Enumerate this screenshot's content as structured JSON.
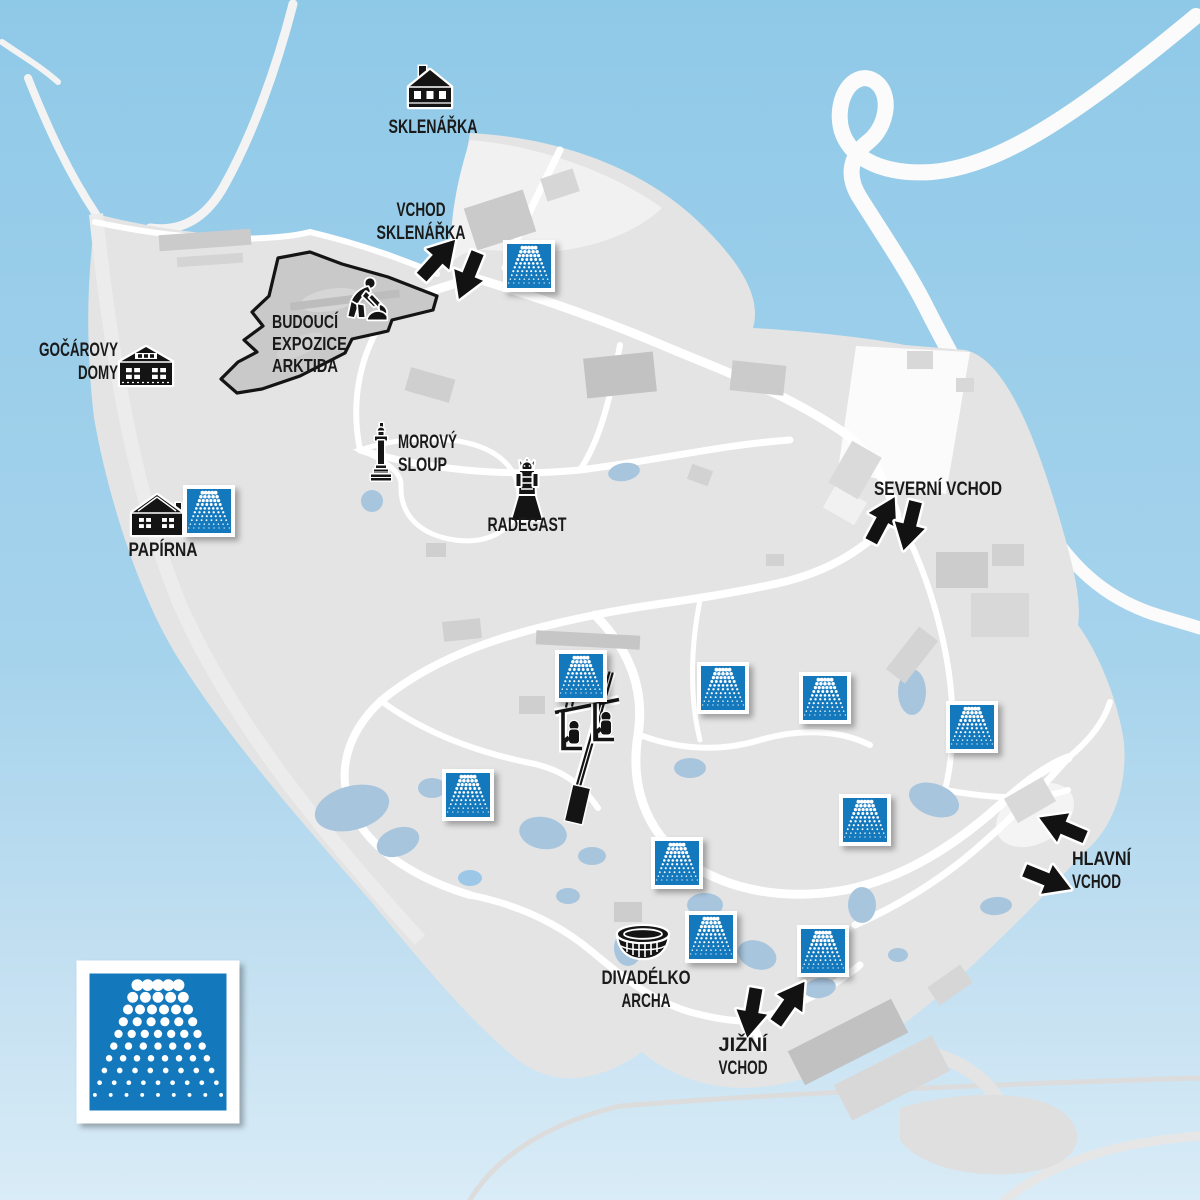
{
  "map_type": "zoo-area-map",
  "colors": {
    "station_blue": "#1478BD",
    "water_top": "#8FC9E8",
    "water_mid": "#A6D3EC",
    "water_bottom": "#D9ECF7",
    "land_grey": "#E4E4E4",
    "label_color": "#1A1A1A",
    "construction_outline": "#141414"
  },
  "labels": [
    {
      "id": "sklenarka",
      "lines": [
        "SKLENÁŘKA"
      ],
      "x": 433,
      "y": 133,
      "anchor": "middle",
      "size": 19
    },
    {
      "id": "vchod-sklenarka",
      "lines": [
        "VCHOD",
        "SKLENÁŘKA"
      ],
      "x": 421,
      "y": 216,
      "anchor": "middle",
      "size": 19
    },
    {
      "id": "budouci-expozice-arktida",
      "lines": [
        "BUDOUCÍ",
        "EXPOZICE",
        "ARKTIDA"
      ],
      "x": 272,
      "y": 328,
      "anchor": "start",
      "size": 18
    },
    {
      "id": "gocarovy-domy",
      "lines": [
        "GOČÁROVY",
        "DOMY"
      ],
      "x": 118,
      "y": 356,
      "anchor": "end",
      "size": 19
    },
    {
      "id": "papirna",
      "lines": [
        "PAPÍRNA"
      ],
      "x": 163,
      "y": 556,
      "anchor": "middle",
      "size": 19
    },
    {
      "id": "morovy-sloup",
      "lines": [
        "MOROVÝ",
        "SLOUP"
      ],
      "x": 398,
      "y": 448,
      "anchor": "start",
      "size": 19
    },
    {
      "id": "radegast",
      "lines": [
        "RADEGAST"
      ],
      "x": 527,
      "y": 531,
      "anchor": "middle",
      "size": 19
    },
    {
      "id": "severni-vchod",
      "lines": [
        "SEVERNÍ VCHOD"
      ],
      "x": 938,
      "y": 495,
      "anchor": "middle",
      "size": 19
    },
    {
      "id": "hlavni-vchod",
      "lines": [
        "HLAVNÍ",
        "VCHOD"
      ],
      "x": 1072,
      "y": 865,
      "anchor": "start",
      "size": 19
    },
    {
      "id": "jizni-vchod",
      "lines": [
        "JIŽNÍ",
        "VCHOD"
      ],
      "x": 743,
      "y": 1051,
      "anchor": "middle",
      "size": 19
    },
    {
      "id": "divadelko-archa",
      "lines": [
        "DIVADÉLKO",
        "ARCHA"
      ],
      "x": 646,
      "y": 984,
      "anchor": "middle",
      "size": 19
    }
  ],
  "poi_icons": [
    {
      "name": "sklenarka-house-icon",
      "icon": "villa",
      "x": 430,
      "y": 88
    },
    {
      "name": "gocarovy-domy-house-icon",
      "icon": "timber",
      "x": 146,
      "y": 366
    },
    {
      "name": "papirna-house-icon",
      "icon": "gable",
      "x": 157,
      "y": 514
    },
    {
      "name": "morovy-sloup-column-icon",
      "icon": "column",
      "x": 381,
      "y": 452
    },
    {
      "name": "radegast-statue-icon",
      "icon": "statue",
      "x": 527,
      "y": 489
    },
    {
      "name": "construction-worker-icon",
      "icon": "worker",
      "x": 364,
      "y": 299
    },
    {
      "name": "chairlift-icon",
      "icon": "chairlift",
      "x": 587,
      "y": 747
    },
    {
      "name": "divadelko-archa-boat-icon",
      "icon": "ark",
      "x": 643,
      "y": 944
    }
  ],
  "misting_stations": [
    {
      "x": 529,
      "y": 266
    },
    {
      "x": 209,
      "y": 511
    },
    {
      "x": 581,
      "y": 676
    },
    {
      "x": 723,
      "y": 688
    },
    {
      "x": 825,
      "y": 698
    },
    {
      "x": 972,
      "y": 727
    },
    {
      "x": 468,
      "y": 795
    },
    {
      "x": 865,
      "y": 820
    },
    {
      "x": 677,
      "y": 863
    },
    {
      "x": 711,
      "y": 937
    },
    {
      "x": 823,
      "y": 951
    }
  ],
  "legend": {
    "name": "misting-station-legend-icon",
    "x": 158,
    "y": 1042,
    "outer": 163,
    "border": 13
  },
  "entrance_arrows": [
    {
      "name": "vchod-sklenarka-arrow-in",
      "x": 437,
      "y": 260,
      "angle": -48
    },
    {
      "name": "vchod-sklenarka-arrow-out",
      "x": 469,
      "y": 274,
      "angle": 112
    },
    {
      "name": "severni-vchod-arrow-in",
      "x": 882,
      "y": 521,
      "angle": -62
    },
    {
      "name": "severni-vchod-arrow-out",
      "x": 910,
      "y": 524,
      "angle": 104
    },
    {
      "name": "hlavni-vchod-arrow-in",
      "x": 1064,
      "y": 828,
      "angle": -157
    },
    {
      "name": "hlavni-vchod-arrow-out",
      "x": 1046,
      "y": 879,
      "angle": 22
    },
    {
      "name": "jizni-vchod-arrow-out",
      "x": 752,
      "y": 1011,
      "angle": 100
    },
    {
      "name": "jizni-vchod-arrow-in",
      "x": 789,
      "y": 1004,
      "angle": -55
    }
  ]
}
